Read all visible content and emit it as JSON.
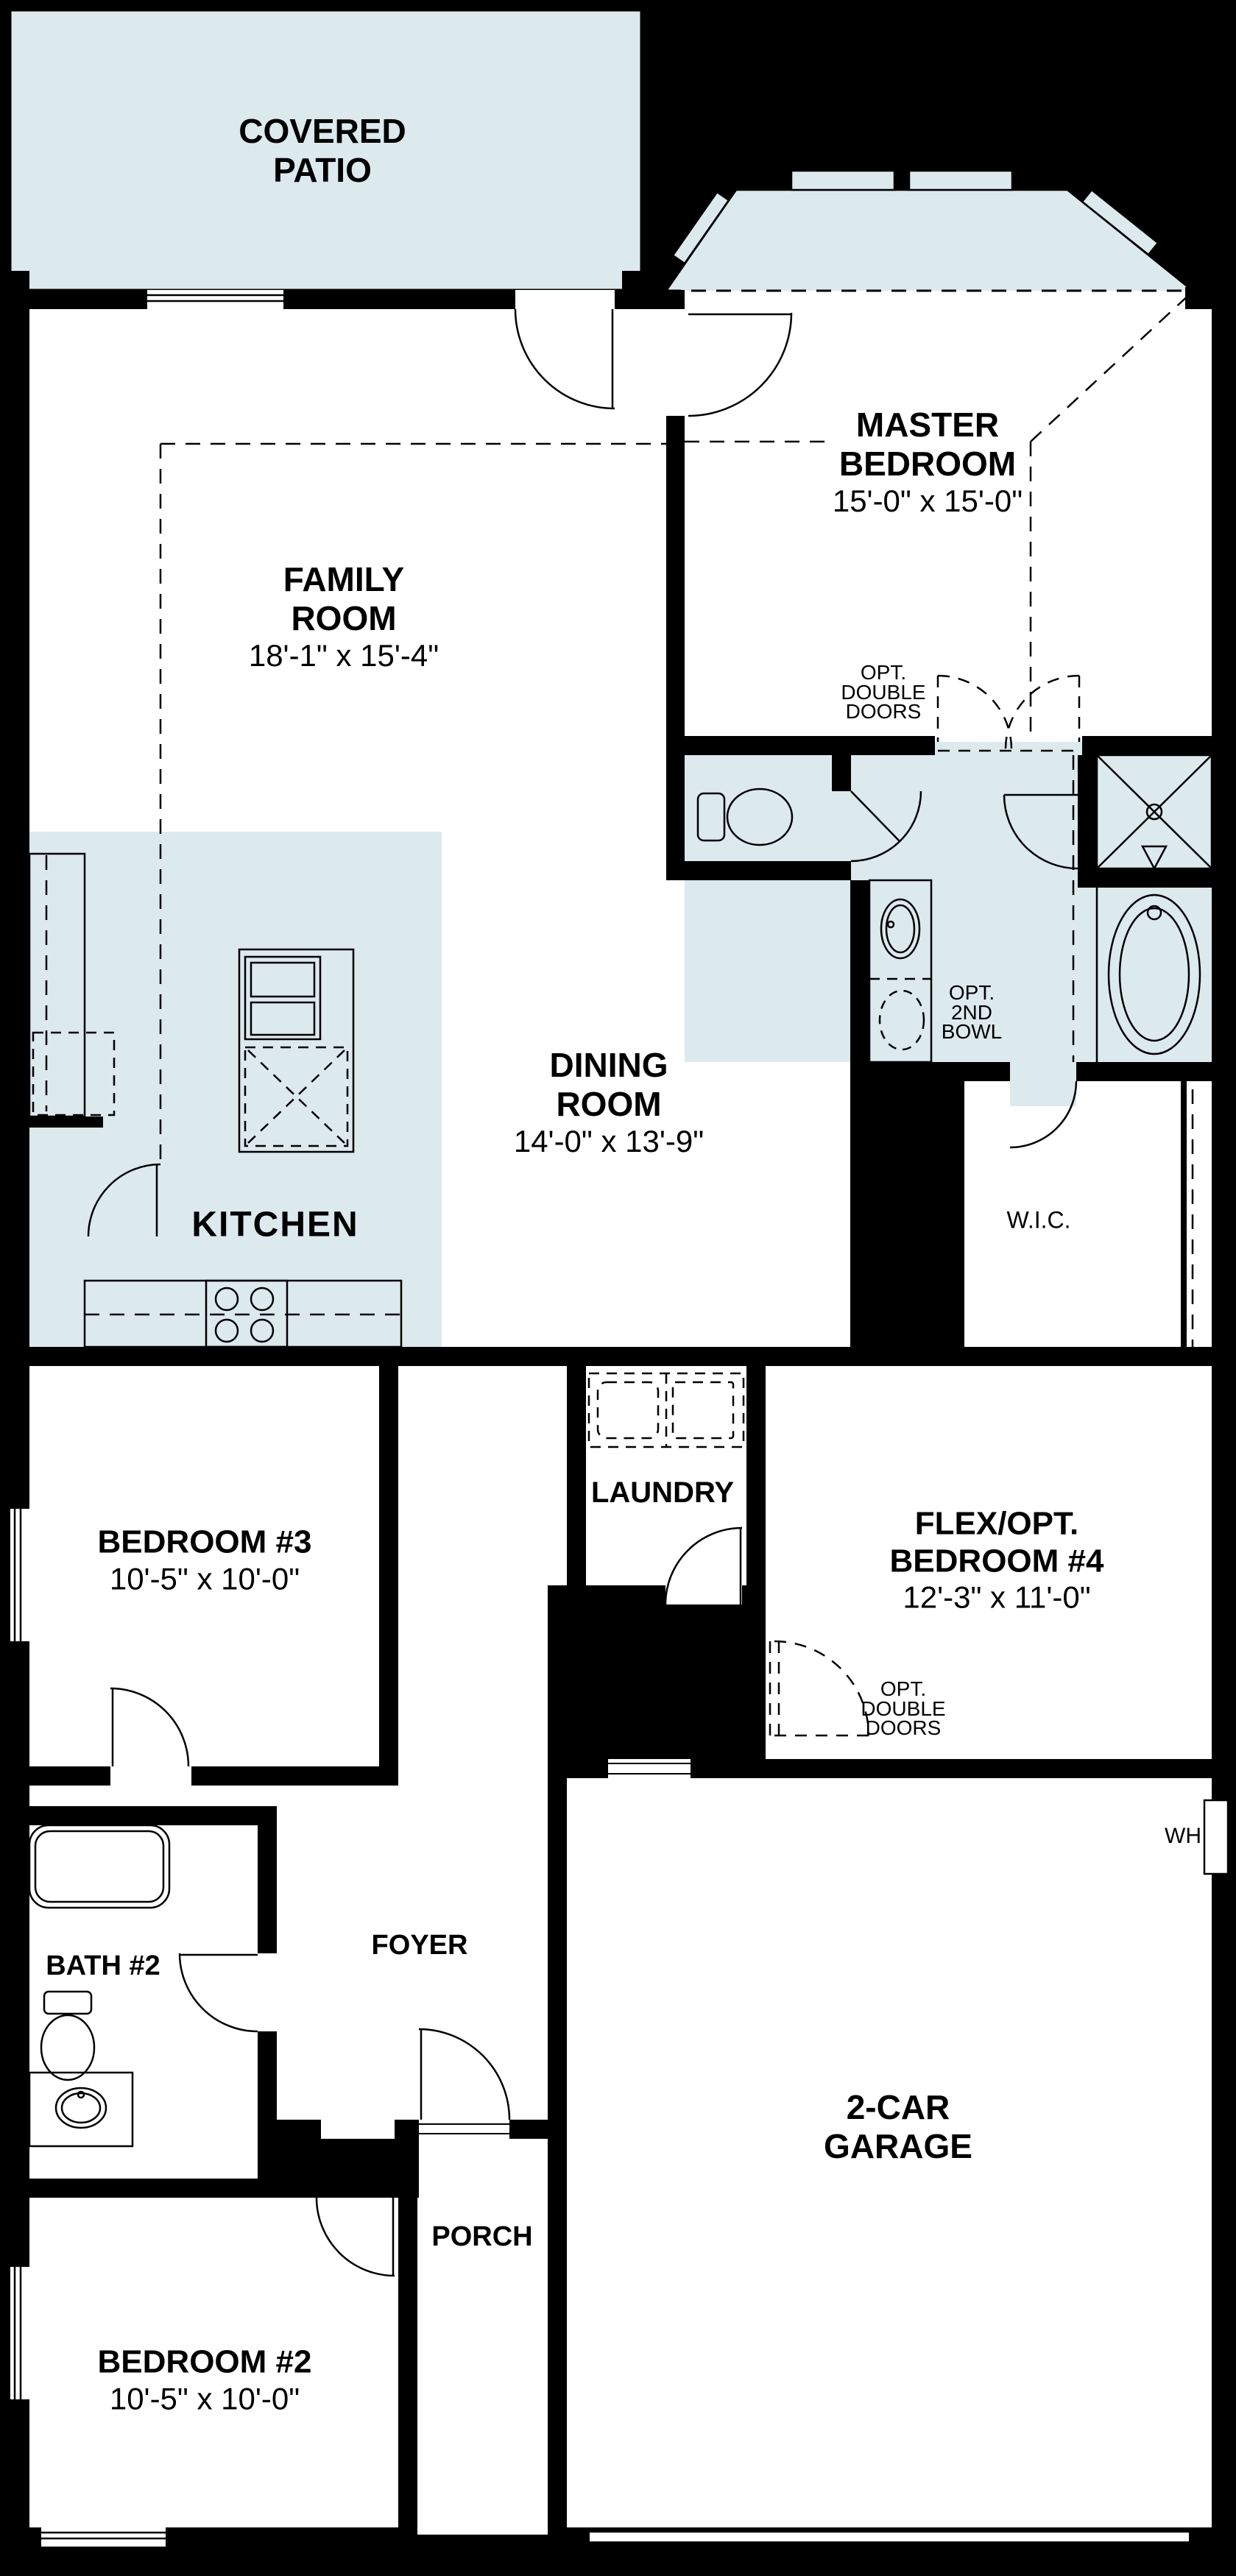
{
  "colors": {
    "background": "#000000",
    "floor": "#ffffff",
    "highlight": "#dce9ed",
    "line": "#000000"
  },
  "rooms": {
    "covered_patio": {
      "line1": "COVERED",
      "line2": "PATIO"
    },
    "family_room": {
      "line1": "FAMILY",
      "line2": "ROOM",
      "dims": "18'-1\" x 15'-4\""
    },
    "master_bedroom": {
      "line1": "MASTER",
      "line2": "BEDROOM",
      "dims": "15'-0\" x 15'-0\""
    },
    "dining_room": {
      "line1": "DINING",
      "line2": "ROOM",
      "dims": "14'-0\" x 13'-9\""
    },
    "kitchen": {
      "name": "KITCHEN"
    },
    "wic": {
      "name": "W.I.C."
    },
    "laundry": {
      "name": "LAUNDRY"
    },
    "bedroom_3": {
      "name": "BEDROOM #3",
      "dims": "10'-5\" x 10'-0\""
    },
    "flex_bedroom_4": {
      "line1": "FLEX/OPT.",
      "line2": "BEDROOM #4",
      "dims": "12'-3\" x 11'-0\""
    },
    "foyer": {
      "name": "FOYER"
    },
    "bath_2": {
      "name": "BATH #2"
    },
    "garage": {
      "line1": "2-CAR",
      "line2": "GARAGE"
    },
    "porch": {
      "name": "PORCH"
    },
    "bedroom_2": {
      "name": "BEDROOM #2",
      "dims": "10'-5\" x 10'-0\""
    }
  },
  "annotations": {
    "opt_double_doors_master": {
      "line1": "OPT.",
      "line2": "DOUBLE",
      "line3": "DOORS"
    },
    "opt_2nd_bowl": {
      "line1": "OPT.",
      "line2": "2ND",
      "line3": "BOWL"
    },
    "opt_double_doors_flex": {
      "line1": "OPT.",
      "line2": "DOUBLE",
      "line3": "DOORS"
    },
    "water_heater": {
      "label": "WH"
    }
  }
}
